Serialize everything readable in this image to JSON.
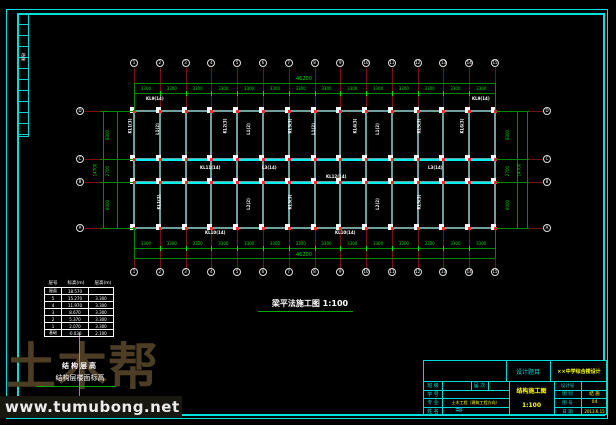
{
  "colors": {
    "frame": "#00e0e0",
    "grid_red": "#7a1010",
    "node_red": "#ff2a2a",
    "dim_line_green": "#008800",
    "dim_text_green": "#00dd00",
    "beam_gray": "#6fa0a0",
    "beam_bright": "#00f0f0",
    "white": "#ffffff",
    "watermark_brown": "#4d3d24",
    "value_yellow": "#ffff00"
  },
  "plan": {
    "title": "梁平法施工图 1:100",
    "axis_numbers": [
      "1",
      "2",
      "3",
      "4",
      "5",
      "6",
      "7",
      "8",
      "9",
      "10",
      "11",
      "12",
      "13",
      "14",
      "15"
    ],
    "axis_letters": [
      "D",
      "C",
      "B",
      "A"
    ],
    "bay_dim": "3300",
    "overall_width_dim": "46200",
    "span_dims": [
      "6000",
      "2700",
      "6000"
    ],
    "overall_depth_dim": "14700",
    "beam_labels": [
      {
        "t": "KL9(14)",
        "x": 146,
        "y": 97,
        "r": 0
      },
      {
        "t": "KL9(14)",
        "x": 472,
        "y": 97,
        "r": 0
      },
      {
        "t": "KL1(3)",
        "x": 123,
        "y": 124,
        "r": 90
      },
      {
        "t": "L1(2)",
        "x": 152,
        "y": 127,
        "r": 90
      },
      {
        "t": "KL2(3)",
        "x": 218,
        "y": 124,
        "r": 90
      },
      {
        "t": "L1(2)",
        "x": 243,
        "y": 127,
        "r": 90
      },
      {
        "t": "KL3(3)",
        "x": 283,
        "y": 124,
        "r": 90
      },
      {
        "t": "L1(2)",
        "x": 308,
        "y": 127,
        "r": 90
      },
      {
        "t": "KL4(3)",
        "x": 348,
        "y": 124,
        "r": 90
      },
      {
        "t": "L1(2)",
        "x": 372,
        "y": 127,
        "r": 90
      },
      {
        "t": "KL5(3)",
        "x": 412,
        "y": 124,
        "r": 90
      },
      {
        "t": "KL6(3)",
        "x": 455,
        "y": 124,
        "r": 90
      },
      {
        "t": "KL1(3)",
        "x": 152,
        "y": 200,
        "r": 90
      },
      {
        "t": "KL3(3)",
        "x": 283,
        "y": 200,
        "r": 90
      },
      {
        "t": "KL5(3)",
        "x": 412,
        "y": 200,
        "r": 90
      },
      {
        "t": "L2(2)",
        "x": 243,
        "y": 202,
        "r": 90
      },
      {
        "t": "L2(2)",
        "x": 372,
        "y": 202,
        "r": 90
      },
      {
        "t": "KL11(14)",
        "x": 200,
        "y": 166,
        "r": 0
      },
      {
        "t": "L3(14)",
        "x": 262,
        "y": 166,
        "r": 0
      },
      {
        "t": "KL12(14)",
        "x": 326,
        "y": 175,
        "r": 0
      },
      {
        "t": "L3(14)",
        "x": 428,
        "y": 166,
        "r": 0
      },
      {
        "t": "KL10(14)",
        "x": 205,
        "y": 231,
        "r": 0
      },
      {
        "t": "KL10(14)",
        "x": 335,
        "y": 231,
        "r": 0
      }
    ]
  },
  "floor_table": {
    "col_headers": [
      "层号",
      "标高(m)",
      "层高(m)"
    ],
    "rows": [
      [
        "屋面",
        "18.570",
        ""
      ],
      [
        "5",
        "15.270",
        "3.300"
      ],
      [
        "4",
        "11.970",
        "3.300"
      ],
      [
        "3",
        "8.670",
        "3.300"
      ],
      [
        "2",
        "5.370",
        "3.300"
      ],
      [
        "1",
        "2.070",
        "3.300"
      ],
      [
        "基础",
        "-0.030",
        "2.100"
      ]
    ],
    "caption1": "结构层高",
    "caption2": "结构层楼面标高"
  },
  "title_block": {
    "project_label": "设计题目",
    "project_value": "××中学综合楼设计",
    "field_class_label": "班 级",
    "field_session_label": "届 次",
    "field_no_label": "学 号",
    "field_major_label": "专 业",
    "field_major_value": "土木工程（建筑工程方向）",
    "field_name_label": "姓 名",
    "signature_mark": "≈",
    "center_line1": "结构施工图",
    "center_line2": "1:100",
    "design_no_label": "设计号",
    "sheet_type_label": "图 别",
    "sheet_type_value": "结 施",
    "sheet_no_label": "图 号",
    "sheet_no_value": "04",
    "date_label": "日 期",
    "date_value": "2013.6.15"
  },
  "sign_strip": {
    "label": "结施"
  },
  "watermark": {
    "big_text": "土木帮",
    "url": "www.tumubong.net"
  }
}
